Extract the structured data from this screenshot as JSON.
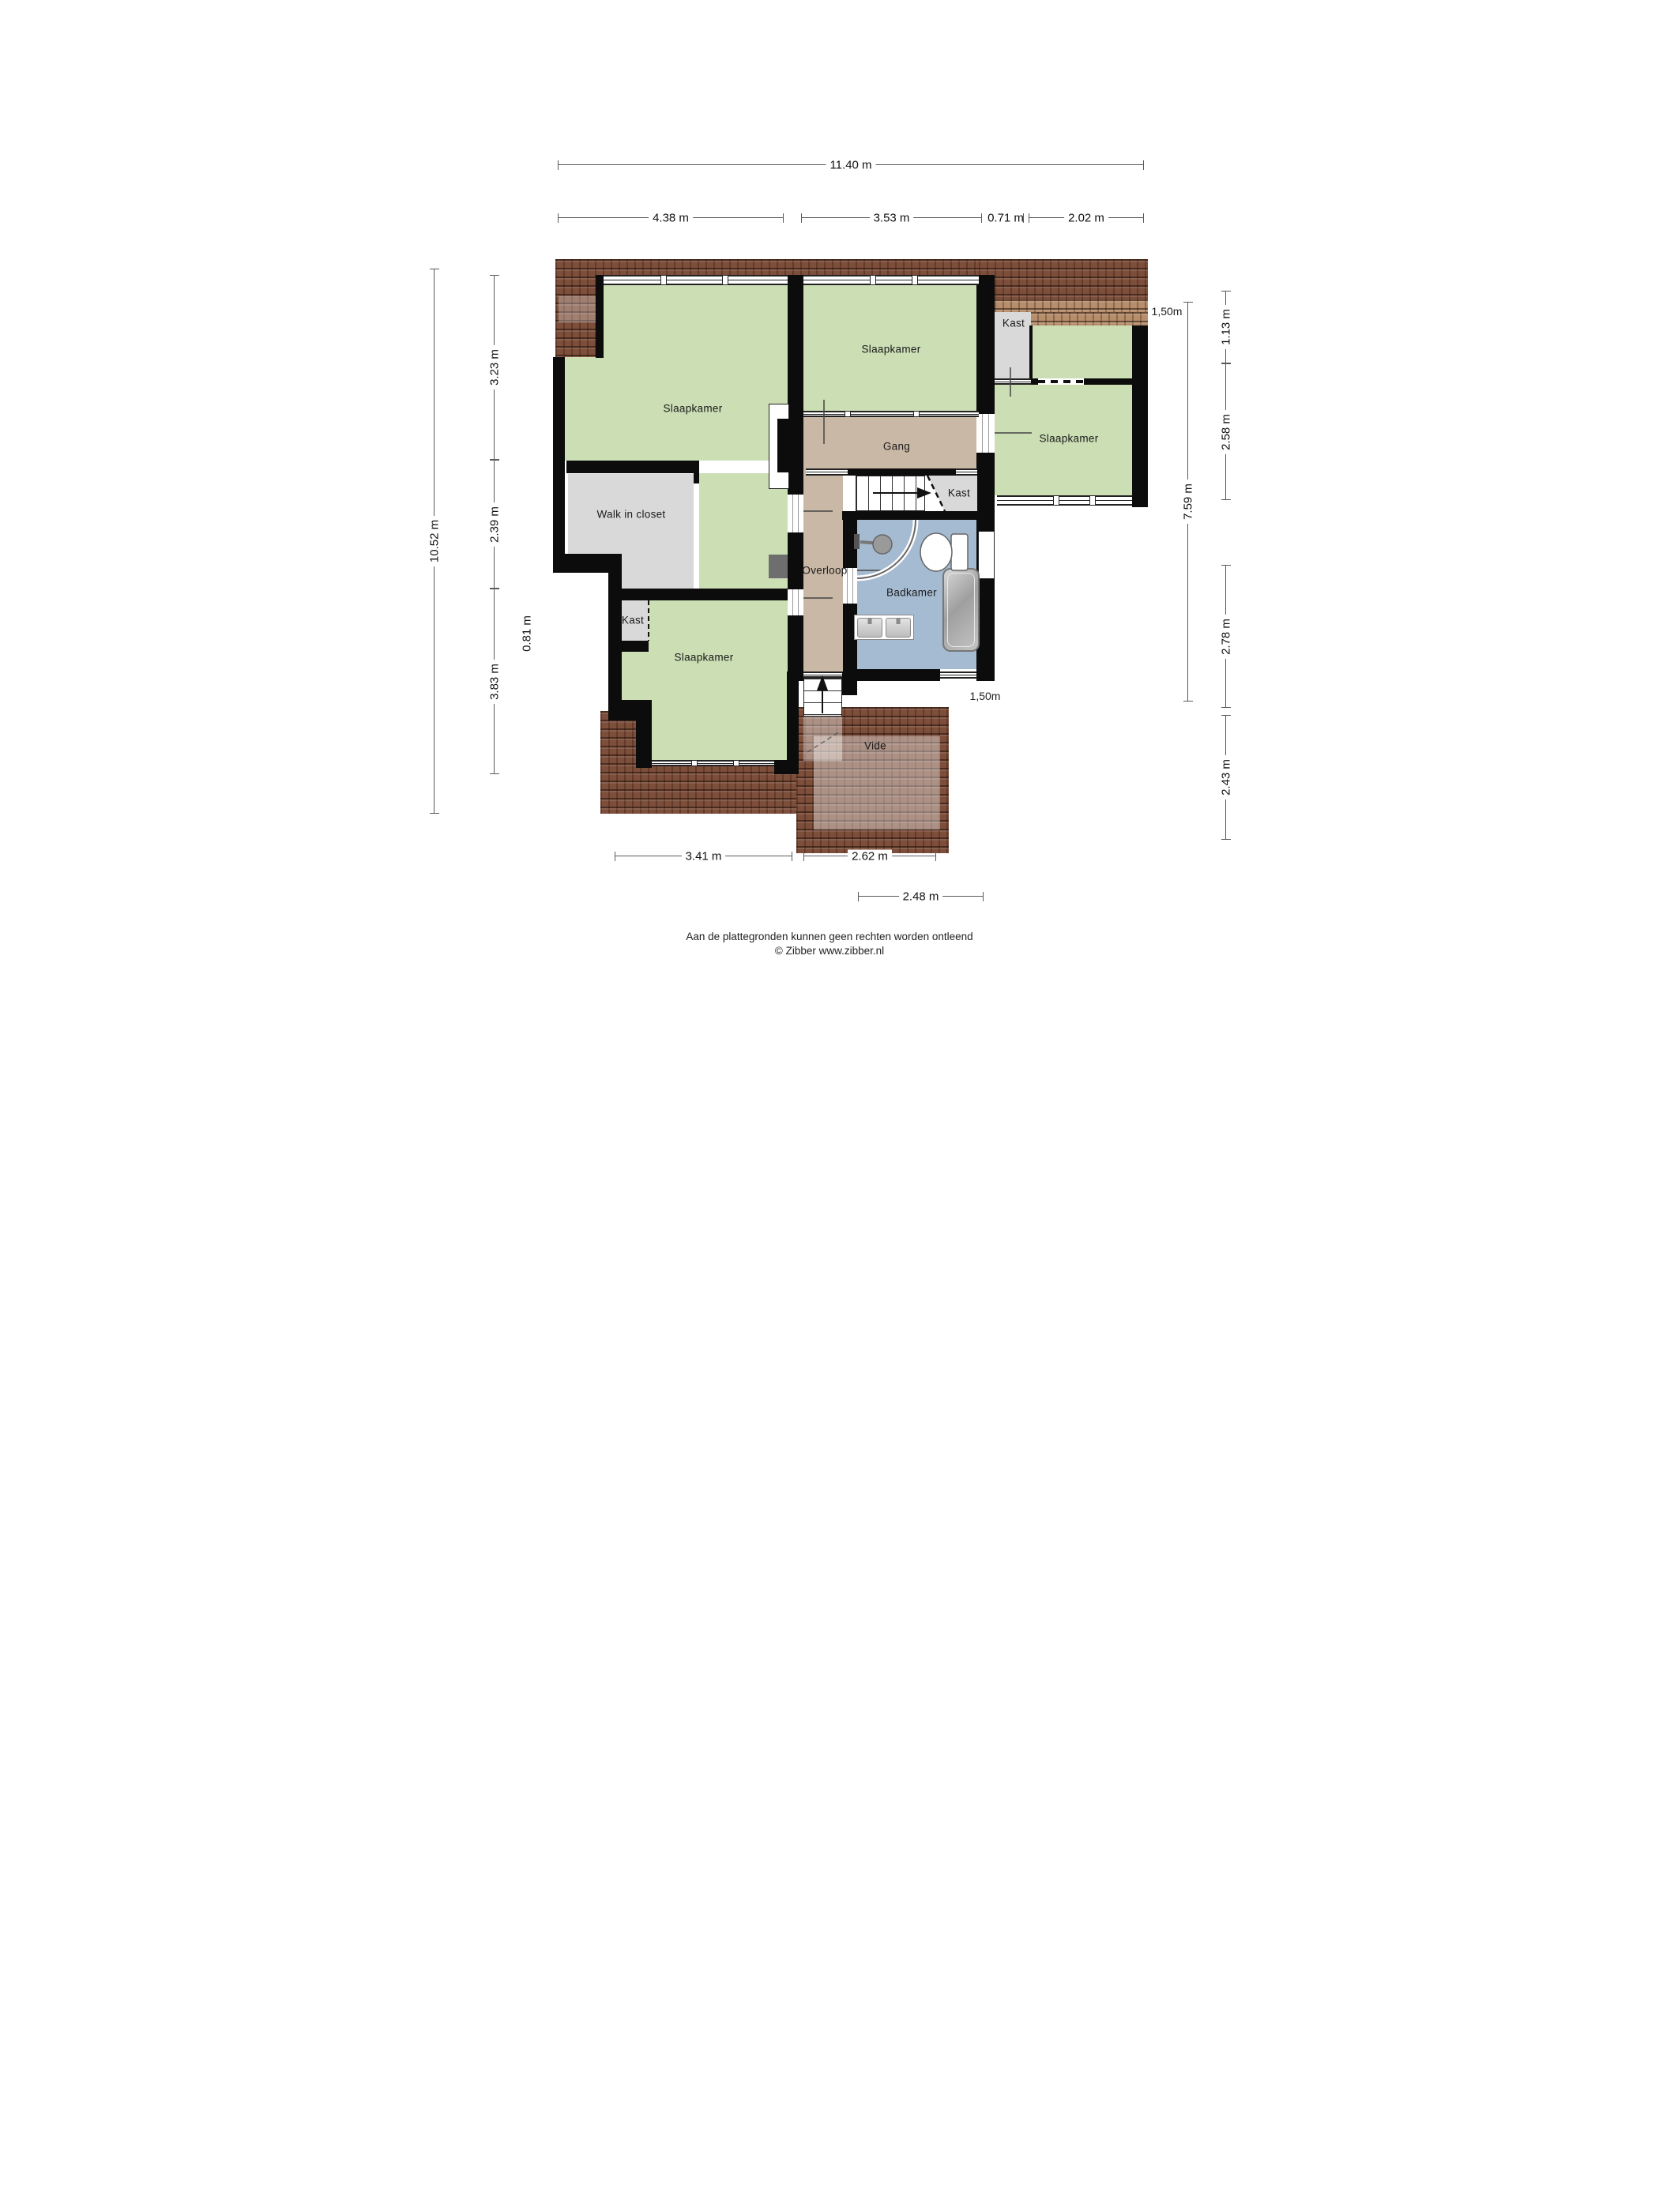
{
  "rooms": {
    "slaapkamer_top_left": "Slaapkamer",
    "slaapkamer_top_middle": "Slaapkamer",
    "slaapkamer_right": "Slaapkamer",
    "slaapkamer_bottom": "Slaapkamer",
    "walk_in_closet": "Walk in closet",
    "gang": "Gang",
    "overloop": "Overloop",
    "badkamer": "Badkamer",
    "kast_top_right": "Kast",
    "kast_middle": "Kast",
    "kast_bottom_left": "Kast",
    "vide": "Vide"
  },
  "dimensions": {
    "top_total": "11.40 m",
    "top_segments": [
      "4.38 m",
      "3.53 m",
      "0.71 m",
      "2.02 m"
    ],
    "left_total": "10.52 m",
    "left_segments": [
      "3.23 m",
      "2.39 m",
      "3.83 m"
    ],
    "left_small": "0.81 m",
    "right_inner": "7.59 m",
    "right_segments": [
      "1.13 m",
      "2.58 m",
      "2.78 m",
      "2.43 m"
    ],
    "bottom_segments": [
      "3.41 m",
      "2.62 m"
    ],
    "bottom_offset_segment": "2.48 m",
    "height_marks": [
      "1,50m",
      "1,50m"
    ]
  },
  "footer": {
    "line1": "Aan de plattegronden kunnen geen rechten worden ontleend",
    "line2": "© Zibber www.zibber.nl"
  },
  "colors": {
    "room_green": "#cbdeb4",
    "corridor_tan": "#c9b8a6",
    "bathroom_blue": "#a5bbd2",
    "closet_gray": "#d9d9d9",
    "wall_black": "#0c0c0c",
    "roof_brown": "#7d4e3a",
    "roof_light": "#b78e6c"
  }
}
